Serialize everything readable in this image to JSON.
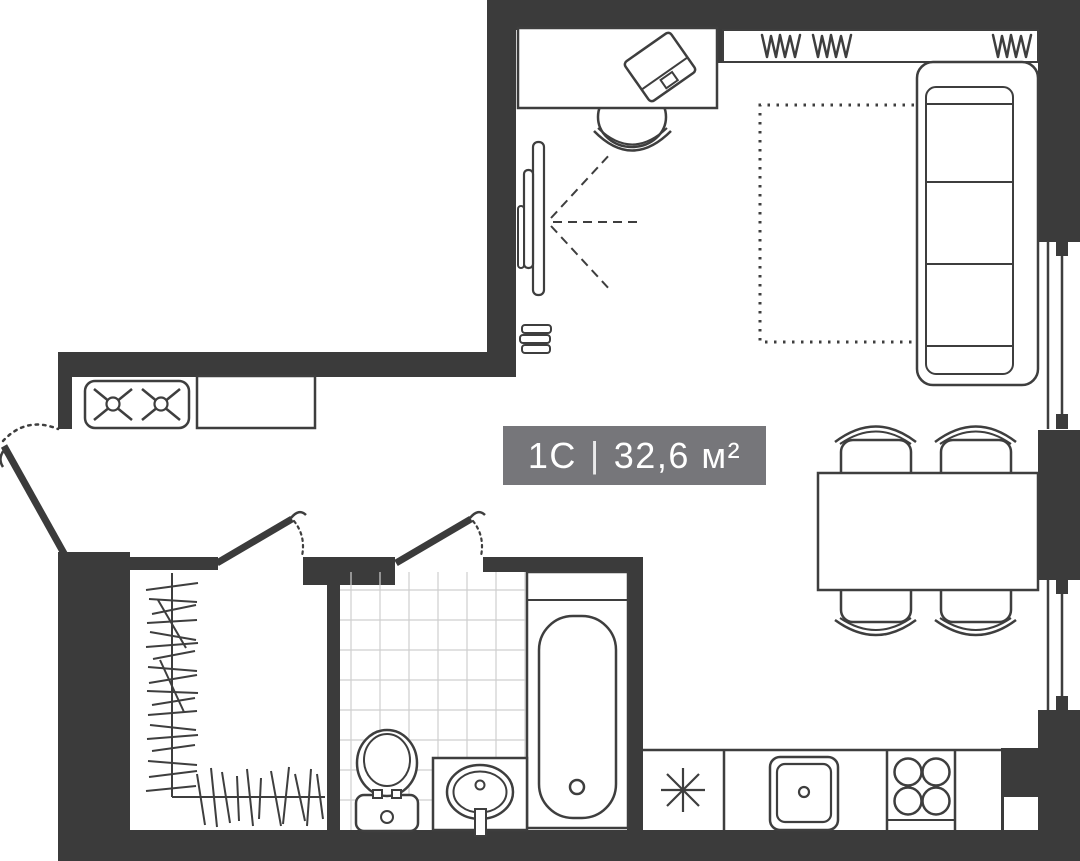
{
  "label": {
    "unit_type": "1С",
    "separator": "|",
    "area": "32,6 м²"
  },
  "colors": {
    "wall": "#3b3b3b",
    "line": "#3e3e3e",
    "tile": "#cfcfcf",
    "label-bg": "#76767a",
    "label-text": "#ffffff",
    "bg": "#ffffff"
  },
  "features": [
    "entry-door",
    "wardrobe-room",
    "bathroom",
    "bathtub",
    "toilet",
    "sink-vanity",
    "stove-2-burner",
    "kitchen-counter",
    "kitchen-sink",
    "hob-4-burner",
    "appliance-slot-asterisk",
    "dining-table",
    "dining-chairs",
    "sofa",
    "rug",
    "desk",
    "desk-chair",
    "laptop",
    "tv",
    "radiator",
    "windows"
  ]
}
